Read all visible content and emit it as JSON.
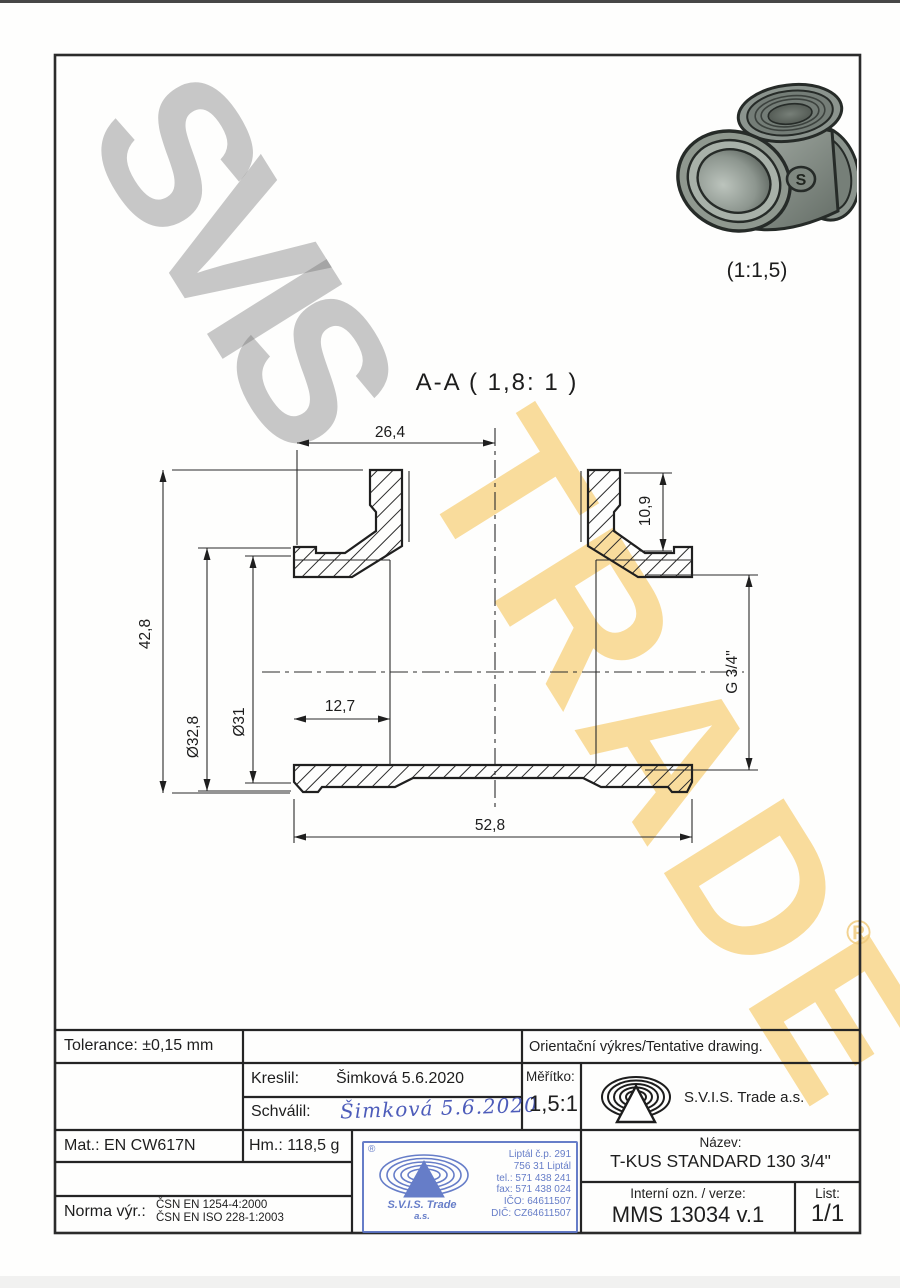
{
  "watermark": {
    "word1": "SVIS",
    "word2": "TRADE",
    "registered": "®",
    "gray_color": "#b6b6b6",
    "yellow_color": "#f5c661"
  },
  "photo": {
    "badge_letter": "S",
    "scale_label": "(1:1,5)"
  },
  "section": {
    "title": "A-A ( 1,8: 1 )"
  },
  "dimensions": {
    "top_width": "26,4",
    "branch_depth": "10,9",
    "overall_height": "42,8",
    "outer_diameter": "Ø32,8",
    "bore_diameter": "Ø31",
    "thread_depth": "12,7",
    "thread_size": "G 3/4\"",
    "overall_length": "52,8"
  },
  "title_block": {
    "tolerance": "Tolerance: ±0,15 mm",
    "orientacni": "Orientační výkres/Tentative drawing.",
    "kreslil_label": "Kreslil:",
    "kreslil_value": "Šimková 5.6.2020",
    "schvalil_label": "Schválil:",
    "schvalil_signature": "Šimková 5.6.2020",
    "meritko_label": "Měřítko:",
    "meritko_value": "1,5:1",
    "company": "S.V.I.S. Trade a.s.",
    "mat": "Mat.: EN CW617N",
    "hm": "Hm.: 118,5 g",
    "norma_label": "Norma výr.:",
    "norma_line1": "ČSN EN 1254-4:2000",
    "norma_line2": "ČSN EN ISO 228-1:2003",
    "nazev_label": "Název:",
    "nazev_value": "T-KUS STANDARD 130 3/4\"",
    "interni_label": "Interní ozn. / verze:",
    "interni_value": "MMS 13034 v.1",
    "list_label": "List:",
    "list_value": "1/1"
  },
  "stamp": {
    "registered": "®",
    "company": "S.V.I.S. Trade",
    "company_suffix": "a.s.",
    "address_line1": "Liptál č.p. 291",
    "address_line2": "756 31 Liptál",
    "address_line3": "tel.: 571 438 241",
    "address_line4": "fax: 571 438 024",
    "address_line5": "IČO: 64611507",
    "address_line6": "DIČ: CZ64611507",
    "color": "#5b74c4"
  }
}
